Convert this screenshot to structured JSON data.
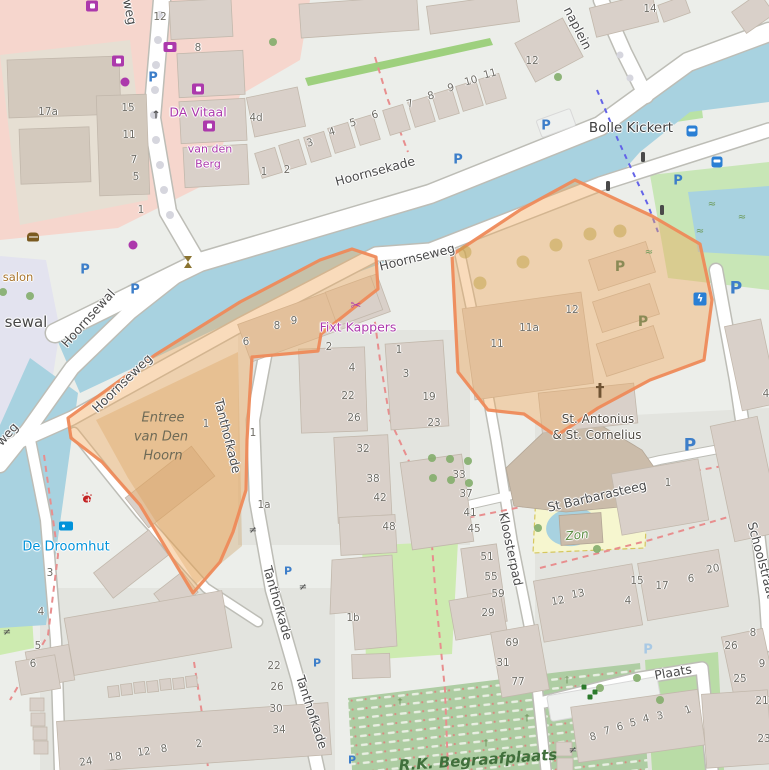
{
  "map": {
    "colors": {
      "water": "#a8d2e0",
      "land": "#eceeea",
      "residential": "#e2e4df",
      "retail_pink": "#f6d6cd",
      "building": "#d9d0c9",
      "church_building": "#cbbcaa",
      "grass": "#cdebb0",
      "cemetery": "#aecda3",
      "pedestrian_plaza": "#e3e3ef",
      "highlight_fill": "#f0a95c",
      "highlight_stroke": "#ee8a5a",
      "parking_blue": "#3d7ec9",
      "shop_purple": "#ac39ac",
      "tourism_blue": "#0092da",
      "veterinary_red": "#c22121",
      "footpath_red": "#e88e8e",
      "route_blue": "#6363e8",
      "street_text": "#4b4b4b",
      "housenumber_text": "#6f6d66"
    },
    "labels": [
      [
        "Hoornsekade",
        375,
        171,
        -15,
        "street",
        "street-name"
      ],
      [
        "Hoornseweg",
        417,
        257,
        -14,
        "street",
        "street-name"
      ],
      [
        "Hoornseweg",
        122,
        383,
        -44,
        "street",
        "street-name"
      ],
      [
        "Hoornsewal",
        88,
        318,
        -48,
        "street",
        "street-name"
      ],
      [
        "Tanthofkade",
        228,
        436,
        76,
        "street",
        "street-name"
      ],
      [
        "Tanthofkade",
        278,
        603,
        74,
        "street",
        "street-name"
      ],
      [
        "Tanthofkade",
        312,
        712,
        72,
        "street",
        "street-name"
      ],
      [
        "Kloosterpad",
        511,
        549,
        78,
        "street",
        "street-name"
      ],
      [
        "St Barbarasteeg",
        597,
        496,
        -13,
        "street",
        "street-name"
      ],
      [
        "Plaats",
        673,
        672,
        -10,
        "street",
        "street-name"
      ],
      [
        "naplein",
        578,
        28,
        63,
        "street",
        "street-name"
      ],
      [
        "Schoolstraat",
        762,
        560,
        75,
        "street",
        "street-name"
      ],
      [
        "weg",
        130,
        12,
        78,
        "street",
        "street-name"
      ],
      [
        "weg",
        7,
        434,
        -48,
        "street",
        "street-name"
      ],
      [
        "sewal",
        26,
        322,
        0,
        "street-big",
        "place-name"
      ],
      [
        "Bolle Kickert",
        631,
        128,
        0,
        "poi-dark",
        "bridge-name"
      ],
      [
        "DA Vitaal",
        198,
        112,
        0,
        "poi-purple",
        "shop-name"
      ],
      [
        "van den",
        210,
        149,
        0,
        "poi-purple-sm",
        "shop-name"
      ],
      [
        "Berg",
        208,
        164,
        0,
        "poi-purple-sm",
        "shop-name"
      ],
      [
        "Fixt Kappers",
        358,
        327,
        0,
        "poi-purple",
        "shop-name"
      ],
      [
        "De Droomhut",
        66,
        547,
        0,
        "poi-blue",
        "guesthouse-name"
      ],
      [
        "salon",
        18,
        277,
        0,
        "poi-tan",
        "shop-name"
      ],
      [
        "Entree",
        163,
        418,
        0,
        "area-gray",
        "area-name"
      ],
      [
        "van Den",
        161,
        437,
        0,
        "area-gray",
        "area-name"
      ],
      [
        "Hoorn",
        163,
        456,
        0,
        "area-gray",
        "area-name"
      ],
      [
        "St. Antonius",
        598,
        419,
        0,
        "poi-dark2",
        "church-name"
      ],
      [
        "& St. Cornelius",
        597,
        435,
        0,
        "poi-dark2",
        "church-name"
      ],
      [
        "Zon",
        577,
        535,
        -6,
        "area-green",
        "garden-name"
      ],
      [
        "R.K. Begraafplaats",
        478,
        760,
        -4,
        "area-green-big",
        "cemetery-name"
      ]
    ],
    "house_numbers": [
      [
        "12",
        160,
        17
      ],
      [
        "8",
        198,
        48
      ],
      [
        "17a",
        48,
        112
      ],
      [
        "15",
        128,
        108
      ],
      [
        "11",
        129,
        135
      ],
      [
        "7",
        134,
        160
      ],
      [
        "5",
        136,
        177
      ],
      [
        "4d",
        256,
        118
      ],
      [
        "1",
        264,
        172
      ],
      [
        "2",
        287,
        170
      ],
      [
        "3",
        310,
        143,
        -15
      ],
      [
        "4",
        332,
        132,
        -15
      ],
      [
        "5",
        353,
        123,
        -15
      ],
      [
        "6",
        375,
        115,
        -15
      ],
      [
        "7",
        410,
        104,
        -15
      ],
      [
        "8",
        431,
        96,
        -15
      ],
      [
        "9",
        451,
        88,
        -15
      ],
      [
        "10",
        471,
        81,
        -15
      ],
      [
        "11",
        490,
        74,
        -15
      ],
      [
        "12",
        532,
        61
      ],
      [
        "14",
        650,
        9
      ],
      [
        "1",
        141,
        210
      ],
      [
        "6",
        246,
        342
      ],
      [
        "8",
        277,
        326
      ],
      [
        "9",
        294,
        321
      ],
      [
        "2",
        329,
        347
      ],
      [
        "1",
        399,
        350
      ],
      [
        "4",
        352,
        368
      ],
      [
        "3",
        406,
        374
      ],
      [
        "22",
        348,
        396
      ],
      [
        "26",
        354,
        418
      ],
      [
        "19",
        429,
        397
      ],
      [
        "23",
        434,
        423
      ],
      [
        "32",
        363,
        449
      ],
      [
        "38",
        373,
        479
      ],
      [
        "42",
        380,
        498
      ],
      [
        "48",
        389,
        527
      ],
      [
        "33",
        459,
        475
      ],
      [
        "37",
        466,
        494
      ],
      [
        "41",
        470,
        513
      ],
      [
        "45",
        474,
        529
      ],
      [
        "51",
        487,
        557
      ],
      [
        "55",
        491,
        577
      ],
      [
        "59",
        498,
        594
      ],
      [
        "29",
        488,
        613
      ],
      [
        "11",
        497,
        344
      ],
      [
        "11a",
        529,
        328
      ],
      [
        "12",
        572,
        310
      ],
      [
        "1",
        206,
        424
      ],
      [
        "1",
        253,
        433
      ],
      [
        "1a",
        264,
        505
      ],
      [
        "1b",
        353,
        618
      ],
      [
        "1",
        668,
        483
      ],
      [
        "3",
        50,
        573
      ],
      [
        "4",
        41,
        612
      ],
      [
        "5",
        38,
        646
      ],
      [
        "6",
        33,
        664
      ],
      [
        "22",
        274,
        666
      ],
      [
        "26",
        277,
        687
      ],
      [
        "30",
        276,
        709
      ],
      [
        "34",
        279,
        730
      ],
      [
        "24",
        86,
        762,
        -8
      ],
      [
        "18",
        115,
        757,
        -8
      ],
      [
        "12",
        144,
        752,
        -8
      ],
      [
        "8",
        164,
        749,
        -8
      ],
      [
        "2",
        199,
        744,
        -8
      ],
      [
        "12",
        558,
        601,
        -10
      ],
      [
        "13",
        578,
        594,
        -10
      ],
      [
        "4",
        628,
        601
      ],
      [
        "15",
        637,
        581
      ],
      [
        "17",
        662,
        586
      ],
      [
        "6",
        691,
        579
      ],
      [
        "20",
        713,
        569,
        -10
      ],
      [
        "8",
        753,
        633
      ],
      [
        "26",
        731,
        646
      ],
      [
        "9",
        762,
        664
      ],
      [
        "25",
        740,
        679
      ],
      [
        "21",
        762,
        701
      ],
      [
        "23",
        764,
        739
      ],
      [
        "69",
        512,
        643
      ],
      [
        "31",
        503,
        663
      ],
      [
        "77",
        518,
        682
      ],
      [
        "8",
        593,
        737,
        -12
      ],
      [
        "7",
        607,
        731,
        -12
      ],
      [
        "6",
        620,
        727,
        -12
      ],
      [
        "5",
        633,
        723,
        -12
      ],
      [
        "4",
        646,
        719,
        -12
      ],
      [
        "3",
        660,
        716,
        -12
      ],
      [
        "1",
        688,
        710,
        -20
      ],
      [
        "4",
        766,
        394
      ]
    ],
    "markers": [
      [
        "mk-p",
        "parking-icon",
        153,
        78,
        "P"
      ],
      [
        "mk-bike",
        "bicycle-icon",
        164,
        88
      ],
      [
        "mk-p",
        "parking-icon",
        458,
        160,
        "P"
      ],
      [
        "mk-p",
        "parking-icon",
        546,
        126,
        "P"
      ],
      [
        "mk-p",
        "parking-icon",
        678,
        181,
        "P"
      ],
      [
        "mk-bike",
        "bicycle-icon",
        691,
        192
      ],
      [
        "mk-p",
        "parking-icon",
        85,
        270,
        "P"
      ],
      [
        "mk-bike",
        "bicycle-icon",
        97,
        279
      ],
      [
        "mk-p",
        "parking-icon",
        135,
        290,
        "P"
      ],
      [
        "mk-p mk-p-big",
        "parking-icon",
        736,
        289,
        "P"
      ],
      [
        "mk-p mk-p-big",
        "parking-icon",
        690,
        446,
        "P"
      ],
      [
        "mk-p mk-p-sm",
        "parking-icon",
        288,
        571,
        "P"
      ],
      [
        "mk-p mk-p-sm",
        "parking-icon",
        317,
        663,
        "P"
      ],
      [
        "mk-p mk-p-sm",
        "parking-icon",
        352,
        760,
        "P"
      ],
      [
        "mk-p-pale",
        "parking-area-icon",
        648,
        650,
        "P"
      ],
      [
        "mk-p-olive",
        "parking-area-icon",
        620,
        267,
        "P"
      ],
      [
        "mk-p-olive",
        "parking-area-icon",
        643,
        322,
        "P"
      ],
      [
        "mk-bus",
        "bus-stop-icon",
        692,
        131
      ],
      [
        "mk-bus",
        "bus-stop-icon",
        717,
        162
      ],
      [
        "mk-tl",
        "traffic-light-icon",
        643,
        157
      ],
      [
        "mk-tl",
        "traffic-light-icon",
        608,
        186
      ],
      [
        "mk-tl",
        "traffic-light-icon",
        662,
        210
      ],
      [
        "mk-tv",
        "tv-shop-icon",
        170,
        47
      ],
      [
        "mk-shop-sq",
        "bakery-icon",
        118,
        61
      ],
      [
        "mk-shop-sq",
        "pharmacy-icon",
        198,
        89
      ],
      [
        "mk-shop-sq",
        "bakery-icon",
        209,
        126
      ],
      [
        "mk-shop-sq",
        "clothes-shop-icon",
        92,
        6
      ],
      [
        "mk-shop-dot",
        "shop-icon",
        125,
        82
      ],
      [
        "mk-shop-dot",
        "shop-icon",
        133,
        245
      ],
      [
        "mk-scissors",
        "hairdresser-icon",
        356,
        306,
        "✂"
      ],
      [
        "mk-burger",
        "fast-food-icon",
        33,
        237
      ],
      [
        "mk-vet",
        "veterinary-icon",
        87,
        497
      ],
      [
        "mk-bed",
        "guesthouse-icon",
        66,
        526
      ],
      [
        "mk-monument",
        "monument-icon",
        188,
        262
      ],
      [
        "mk-ev",
        "ev-charging-icon",
        700,
        299,
        "ϟ"
      ],
      [
        "mk-cross-big",
        "church-cross-icon",
        600,
        391,
        "†"
      ],
      [
        "mk-gate",
        "gate-icon",
        253,
        531,
        "≠"
      ],
      [
        "mk-gate",
        "gate-icon",
        303,
        588,
        "≠"
      ],
      [
        "mk-gate",
        "gate-icon",
        573,
        751,
        "≠"
      ],
      [
        "mk-gate",
        "gate-icon",
        7,
        633,
        "≠"
      ],
      [
        "mk-arrow",
        "oneway-arrow-icon",
        156,
        115,
        "↑"
      ],
      [
        "mk-marsh",
        "marsh-icon",
        649,
        253,
        "≈"
      ],
      [
        "mk-marsh",
        "marsh-icon",
        712,
        205,
        "≈"
      ],
      [
        "mk-marsh",
        "marsh-icon",
        742,
        218,
        "≈"
      ],
      [
        "mk-marsh",
        "marsh-icon",
        700,
        232,
        "≈"
      ],
      [
        "mk-tree",
        "tree-icon",
        273,
        42
      ],
      [
        "mk-tree",
        "tree-icon",
        558,
        77
      ],
      [
        "mk-tree",
        "tree-icon",
        3,
        292
      ],
      [
        "mk-tree",
        "tree-icon",
        30,
        296
      ],
      [
        "mk-tree",
        "tree-icon",
        432,
        458
      ],
      [
        "mk-tree",
        "tree-icon",
        450,
        459
      ],
      [
        "mk-tree",
        "tree-icon",
        468,
        461
      ],
      [
        "mk-tree",
        "tree-icon",
        433,
        478
      ],
      [
        "mk-tree",
        "tree-icon",
        451,
        480
      ],
      [
        "mk-tree",
        "tree-icon",
        469,
        483
      ],
      [
        "mk-tree",
        "tree-icon",
        538,
        528
      ],
      [
        "mk-tree",
        "tree-icon",
        597,
        549
      ],
      [
        "mk-tree",
        "tree-icon",
        600,
        688
      ],
      [
        "mk-tree",
        "tree-icon",
        637,
        678
      ],
      [
        "mk-tree",
        "tree-icon",
        660,
        700
      ],
      [
        "mk-tree-olive",
        "tree-icon",
        480,
        283
      ],
      [
        "mk-tree-olive",
        "tree-icon",
        523,
        262
      ],
      [
        "mk-tree-olive",
        "tree-icon",
        556,
        245
      ],
      [
        "mk-tree-olive",
        "tree-icon",
        590,
        234
      ],
      [
        "mk-tree-olive",
        "tree-icon",
        620,
        231
      ],
      [
        "mk-tree-olive",
        "tree-icon",
        465,
        252
      ],
      [
        "mk-cross-sm",
        "grave-cross-icon",
        400,
        703,
        "†"
      ],
      [
        "mk-cross-sm",
        "grave-cross-icon",
        486,
        744,
        "†"
      ],
      [
        "mk-cross-sm",
        "grave-cross-icon",
        527,
        719,
        "†"
      ],
      [
        "mk-cross-sm",
        "grave-cross-icon",
        567,
        681,
        "†"
      ],
      [
        "mk-play",
        "playground-icon",
        584,
        687
      ],
      [
        "mk-play",
        "playground-icon",
        595,
        692
      ],
      [
        "mk-play",
        "playground-icon",
        590,
        697
      ]
    ]
  }
}
